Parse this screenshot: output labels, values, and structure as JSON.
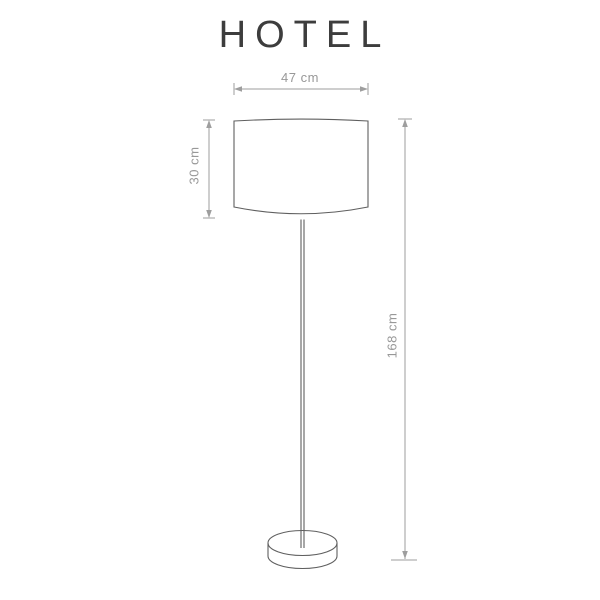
{
  "title": "HOTEL",
  "diagram": {
    "product_name": "HOTEL",
    "type": "floor-lamp-dimension-drawing",
    "dimensions": {
      "shade_width": {
        "label": "47 cm",
        "value": 47,
        "unit": "cm"
      },
      "shade_height": {
        "label": "30 cm",
        "value": 30,
        "unit": "cm"
      },
      "total_height": {
        "label": "168 cm",
        "value": 168,
        "unit": "cm"
      }
    },
    "parts": [
      "lamp-shade",
      "lamp-pole",
      "lamp-base"
    ],
    "colors": {
      "background": "#ffffff",
      "title": "#3d3d3d",
      "outline": "#5f5f5f",
      "dimension_line": "#9e9e9e",
      "dimension_text": "#989898"
    }
  }
}
